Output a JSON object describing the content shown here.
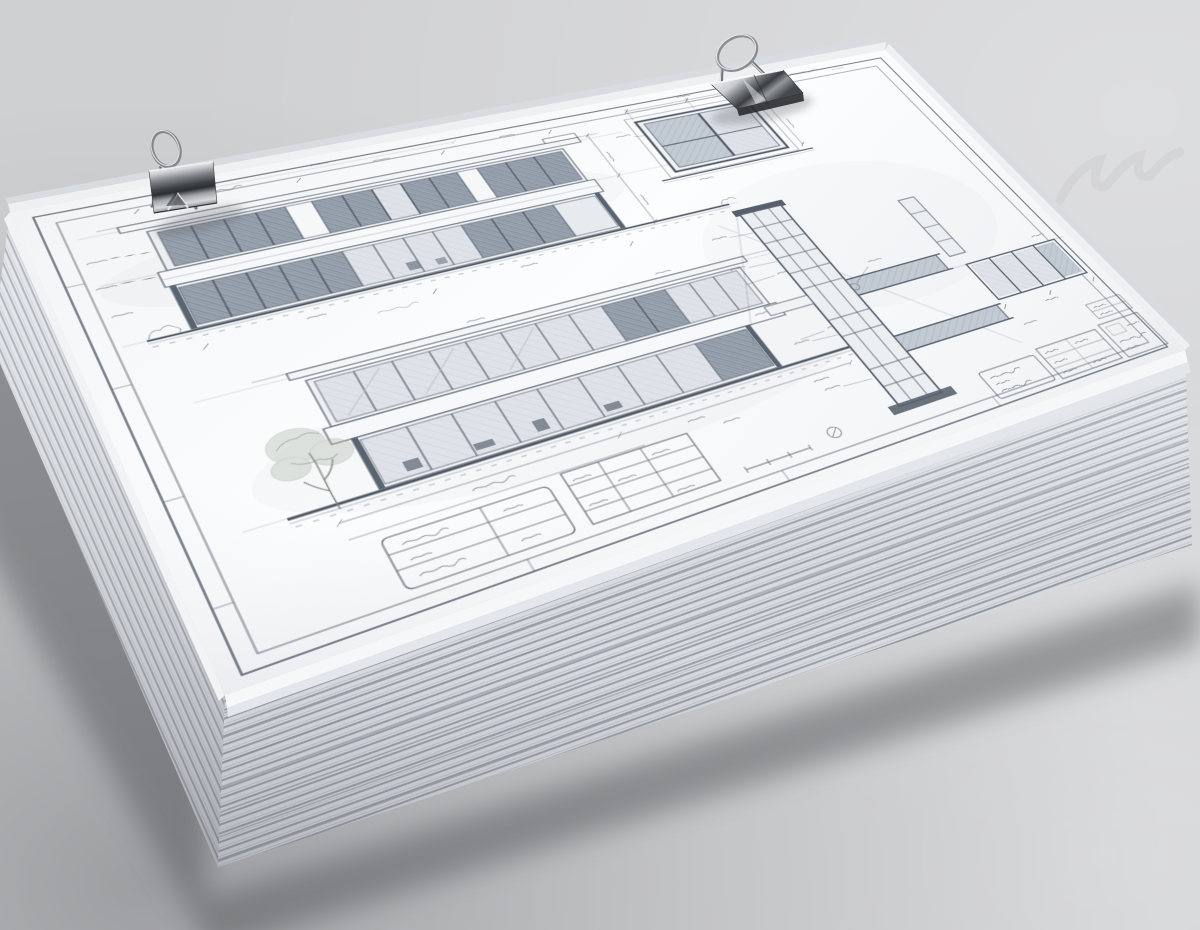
{
  "scene": {
    "kind": "photograph",
    "description": "A thick stack of architectural drawing sheets lies on a gray tabletop, secured with two polished-steel binder clips. The top sheet is a pencil blueprint of a modern flat-roofed house: two long elevation views on the left, a square window detail and a tall glazing section on the right, with a schedule table and title-block boxes along the bottom border. All annotation text is tiny illegible pencil scribble.",
    "watermark": "faint illegible diagonal watermark near the top-right of the surface",
    "background": {
      "base": "#d2d3d5",
      "dark_corner": "#97979b",
      "light_corner": "#dfe0e2"
    },
    "stack_shadow": "#55585c",
    "paper": {
      "face": "#fafbfc",
      "edge_light": "#dde0e4",
      "edge_mid": "#c3c8cf",
      "edge_dark": "#9ba1ac"
    },
    "ink": {
      "line": "#5c6673",
      "line_heavy": "#4e5864",
      "glass_dark": "#99a3af",
      "glass_light": "#dfe3e9",
      "foliage": "#a9b4a6"
    },
    "clip_metal": {
      "highlight": "#f2f3f4",
      "mid": "#84888d",
      "shadow": "#2b2e32"
    }
  },
  "stack": {
    "visible_edge_layers": 26,
    "rotation_on_table_deg": -20
  },
  "clips": [
    {
      "id": "binder-clip-left",
      "location": "near the top-left corner of the stack",
      "finish": "polished steel",
      "handle": "wire loop raised upright"
    },
    {
      "id": "binder-clip-top",
      "location": "middle of the top edge of the stack",
      "finish": "polished steel",
      "handle": "wire loop raised upright"
    }
  ],
  "sheet": {
    "border": "double ruled frame",
    "views": [
      {
        "id": "upper-elevation",
        "type": "building elevation",
        "storeys": 2,
        "window_bands": 2,
        "dark_glazed_panels": true
      },
      {
        "id": "lower-elevation",
        "type": "building elevation",
        "storeys": 2,
        "window_bands": 2,
        "tree_sketch": true,
        "furniture_silhouettes": true
      },
      {
        "id": "window-detail",
        "type": "square window detail with dimension lines"
      },
      {
        "id": "section-detail",
        "type": "tall vertical glazing section with floor slabs"
      },
      {
        "id": "strip-window-detail",
        "type": "horizontal strip window detail"
      },
      {
        "id": "schedule-table",
        "type": "schedule / legend table"
      },
      {
        "id": "title-block",
        "type": "title block boxes in bottom-right corner"
      }
    ],
    "annotations": "illegible pencil dimension strings, leader notes and soil hatching"
  }
}
